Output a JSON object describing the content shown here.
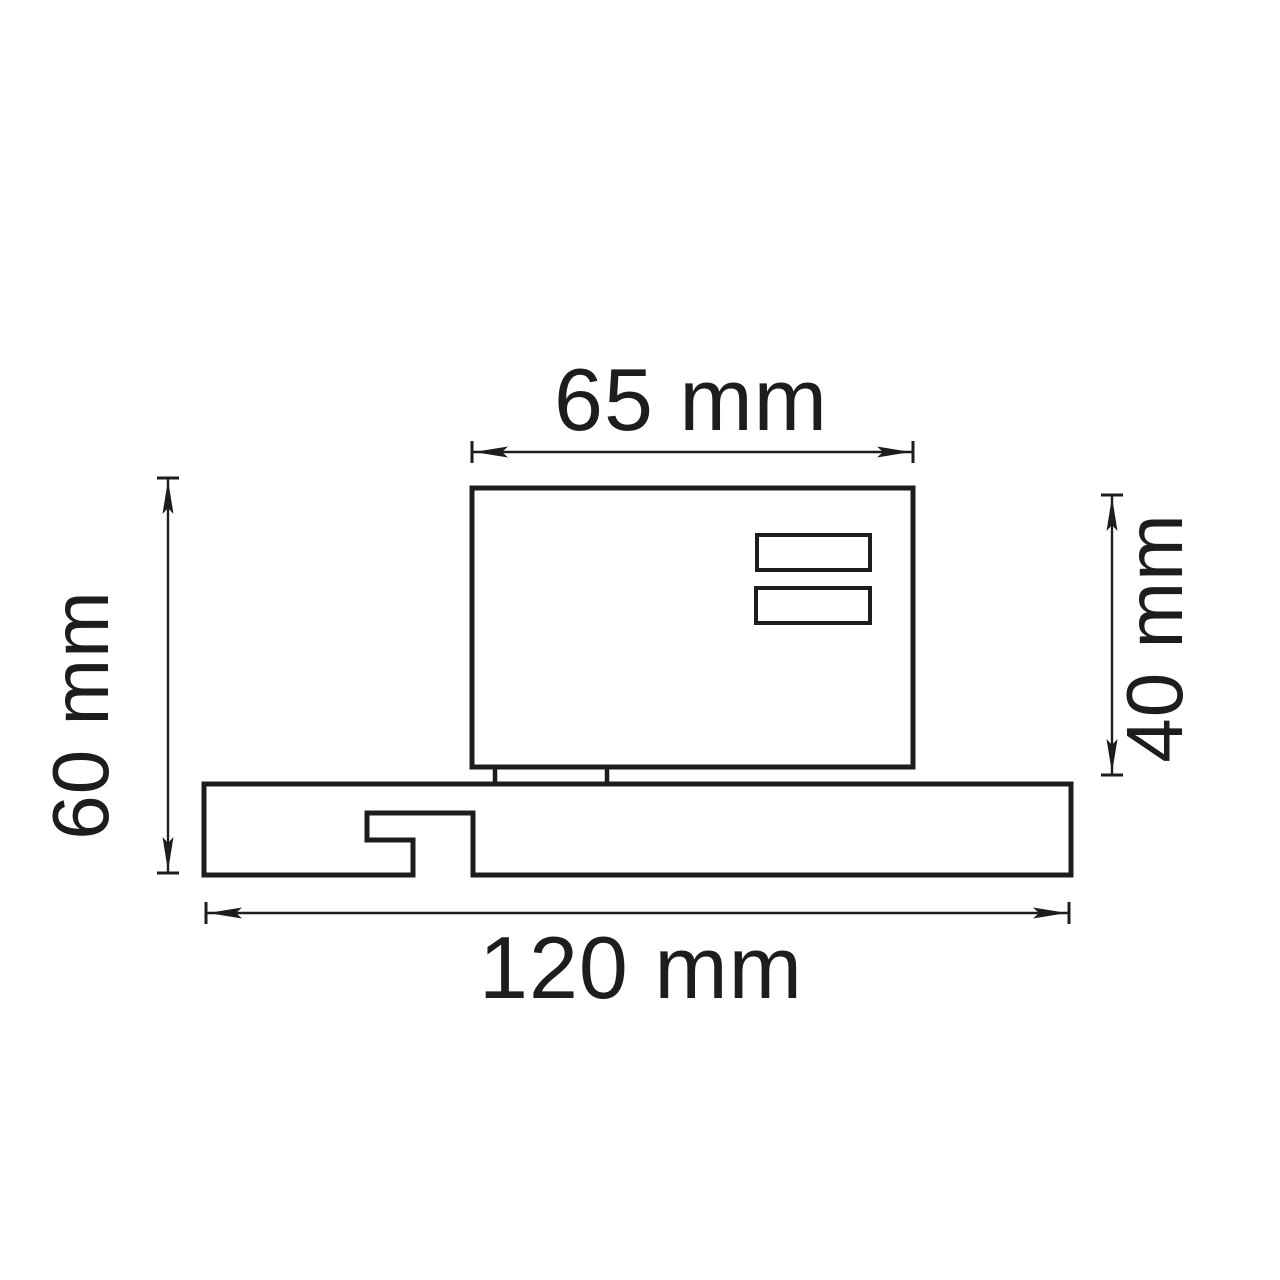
{
  "canvas": {
    "background": "#ffffff",
    "line_color": "#1d1d1b"
  },
  "drawing": {
    "type": "technical-dimension-drawing",
    "view": "side profile of track adapter on mounting track",
    "dimensions": {
      "top_width": {
        "label": "65 mm",
        "value": 65,
        "unit": "mm",
        "orientation": "horizontal"
      },
      "left_height": {
        "label": "60 mm",
        "value": 60,
        "unit": "mm",
        "orientation": "vertical"
      },
      "right_height": {
        "label": "40 mm",
        "value": 40,
        "unit": "mm",
        "orientation": "vertical"
      },
      "bottom_width": {
        "label": "120 mm",
        "value": 120,
        "unit": "mm",
        "orientation": "horizontal"
      }
    }
  }
}
